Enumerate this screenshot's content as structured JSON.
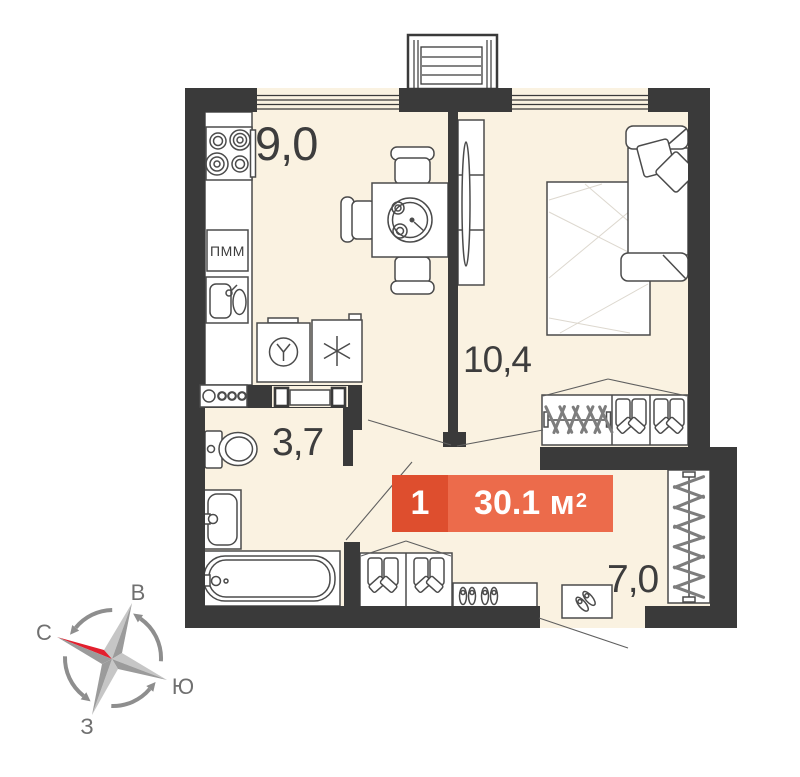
{
  "plan": {
    "type": "floor-plan",
    "rooms": [
      {
        "name": "kitchen",
        "area": "9,0"
      },
      {
        "name": "living-room",
        "area": "10,4"
      },
      {
        "name": "bathroom",
        "area": "3,7"
      },
      {
        "name": "hallway",
        "area": "7,0"
      }
    ],
    "badge": {
      "rooms_count": "1",
      "area_main": "30.1 м",
      "area_sup": "2"
    },
    "appliances": {
      "dishwasher": "ПММ"
    },
    "compass": {
      "east": "В",
      "north": "С",
      "south": "Ю",
      "west": "З"
    },
    "colors": {
      "wall": "#3a3a3a",
      "floor": "#faf2e1",
      "badge_dark": "#de4e2e",
      "badge_light": "#ec6b4b",
      "compass_red": "#e2202e"
    }
  }
}
